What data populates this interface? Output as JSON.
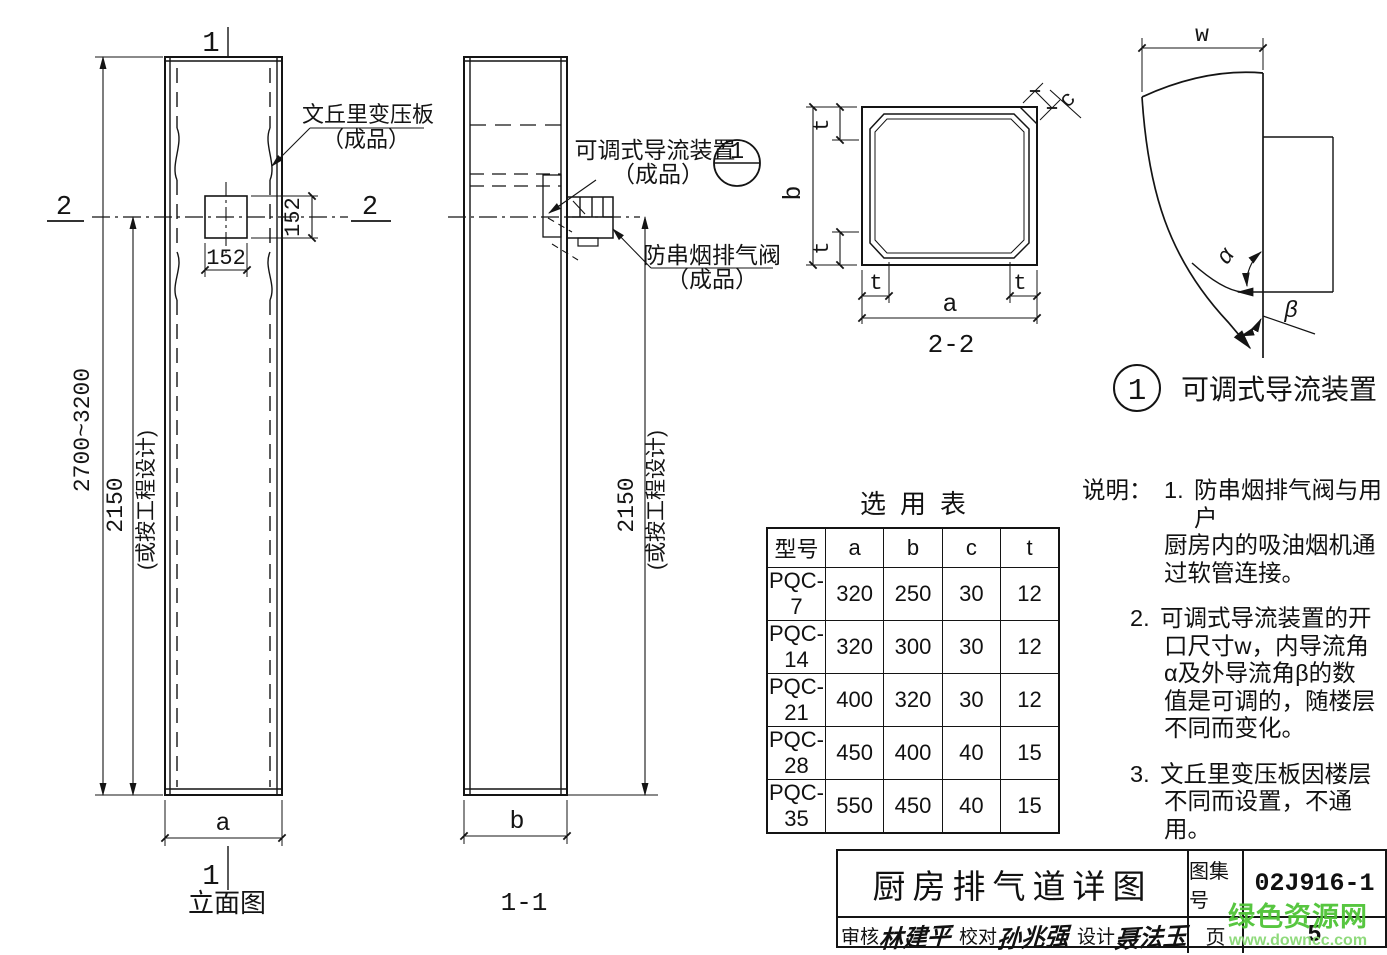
{
  "drawing": {
    "elevation": {
      "label": "立面图",
      "section_mark_1": "1",
      "section_mark_2": "2",
      "dim_total_height": "2700~3200",
      "dim_height": "2150",
      "dim_height_note": "(或按工程设计)",
      "dim_opening_width": "152",
      "dim_opening_height": "152",
      "dim_width": "a",
      "callout_venturi": {
        "line1": "文丘里变压板",
        "line2": "（成品）"
      }
    },
    "section_1_1": {
      "label": "1-1",
      "dim_height": "2150",
      "dim_height_note": "(或按工程设计)",
      "dim_width": "b",
      "callout_deflector": {
        "line1": "可调式导流装置",
        "line2": "（成品）"
      },
      "callout_valve": {
        "line1": "防串烟排气阀",
        "line2": "（成品）"
      },
      "detail_ref": "1"
    },
    "section_2_2": {
      "label": "2-2",
      "dim_a": "a",
      "dim_b": "b",
      "dim_c": "c",
      "dim_t": "t"
    },
    "detail_1": {
      "bubble": "1",
      "title": "可调式导流装置",
      "dim_w": "w",
      "angle_inner": "α",
      "angle_outer": "β"
    }
  },
  "selection_table": {
    "title": "选用表",
    "headers": [
      "型号",
      "a",
      "b",
      "c",
      "t"
    ],
    "rows": [
      [
        "PQC-7",
        "320",
        "250",
        "30",
        "12"
      ],
      [
        "PQC-14",
        "320",
        "300",
        "30",
        "12"
      ],
      [
        "PQC-21",
        "400",
        "320",
        "30",
        "12"
      ],
      [
        "PQC-28",
        "450",
        "400",
        "40",
        "15"
      ],
      [
        "PQC-35",
        "550",
        "450",
        "40",
        "15"
      ]
    ]
  },
  "notes": {
    "label": "说明：",
    "items": [
      {
        "num": "1.",
        "lines": [
          "防串烟排气阀与用户",
          "厨房内的吸油烟机通",
          "过软管连接。"
        ]
      },
      {
        "num": "2.",
        "lines": [
          "可调式导流装置的开",
          "口尺寸w，内导流角",
          "α及外导流角β的数",
          "值是可调的，随楼层",
          "不同而变化。"
        ]
      },
      {
        "num": "3.",
        "lines": [
          "文丘里变压板因楼层",
          "不同而设置，不通用。"
        ]
      }
    ]
  },
  "title_block": {
    "drawing_title": "厨房排气道详图",
    "atlas_label": "图集号",
    "atlas_number": "02J916-1",
    "page_label": "页",
    "page_number": "5",
    "reviewer_label": "审核",
    "reviewer_signature": "林建平",
    "checker_label": "校对",
    "checker_signature": "孙兆强",
    "designer_label": "设计",
    "designer_signature": "聂法玉"
  },
  "watermark": {
    "site_name": "绿色资源网",
    "site_url": "www.downcc.com",
    "color": "#4fc436"
  }
}
